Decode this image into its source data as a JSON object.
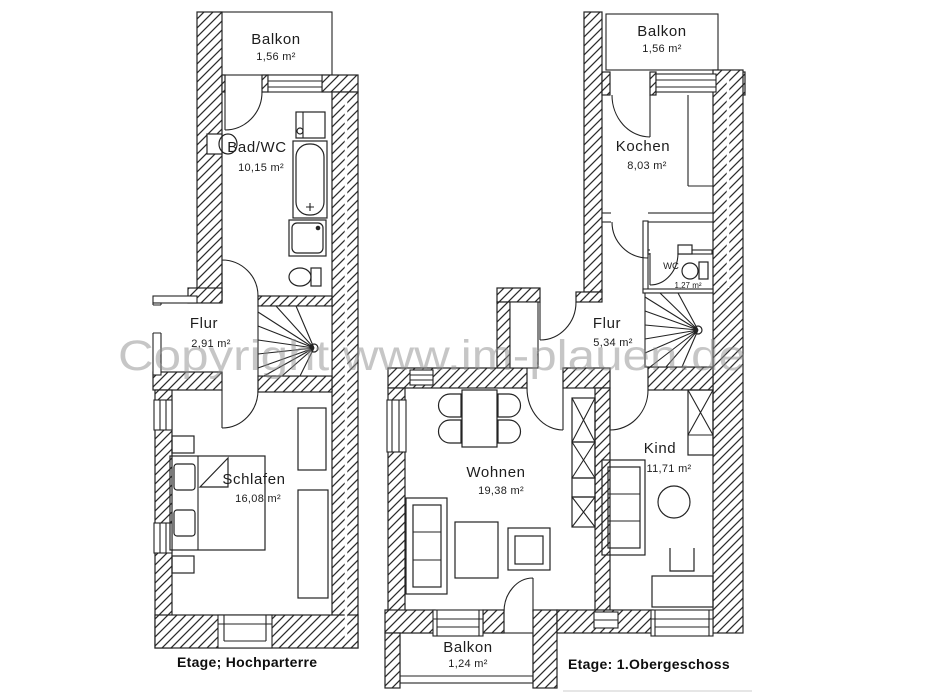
{
  "watermark": "Copyright www.im-plauen.de",
  "floors": {
    "hochparterre": {
      "caption": "Etage; Hochparterre",
      "rooms": {
        "balkon": {
          "name": "Balkon",
          "area": "1,56 m²"
        },
        "bad_wc": {
          "name": "Bad/WC",
          "area": "10,15 m²"
        },
        "flur": {
          "name": "Flur",
          "area": "2,91 m²"
        },
        "schlafen": {
          "name": "Schlafen",
          "area": "16,08 m²"
        }
      }
    },
    "obergeschoss": {
      "caption": "Etage: 1.Obergeschoss",
      "rooms": {
        "balkon_oben": {
          "name": "Balkon",
          "area": "1,56 m²"
        },
        "kochen": {
          "name": "Kochen",
          "area": "8,03 m²"
        },
        "wc": {
          "name": "WC",
          "area": "1,27 m²"
        },
        "flur": {
          "name": "Flur",
          "area": "5,34 m²"
        },
        "wohnen": {
          "name": "Wohnen",
          "area": "19,38 m²"
        },
        "kind": {
          "name": "Kind",
          "area": "11,71 m²"
        },
        "balkon_unten": {
          "name": "Balkon",
          "area": "1,24 m²"
        }
      }
    }
  }
}
